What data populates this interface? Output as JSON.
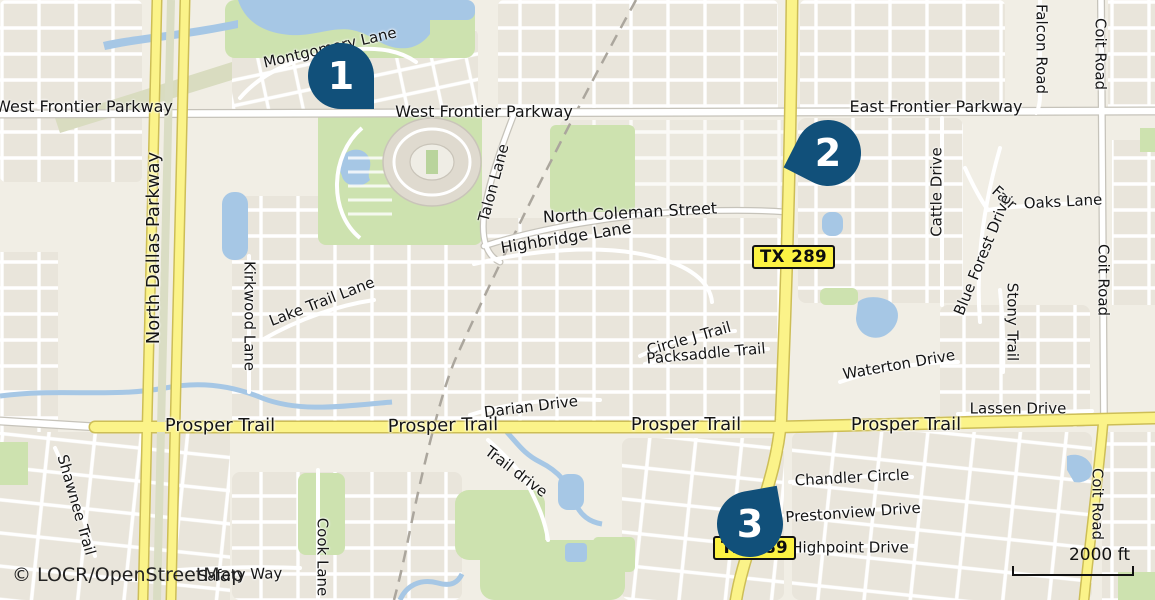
{
  "map": {
    "attribution": "© LOCR/OpenStreetMap",
    "scale_label": "2000 ft",
    "markers": [
      {
        "number": "1"
      },
      {
        "number": "2"
      },
      {
        "number": "3"
      }
    ],
    "shields": [
      {
        "label": "TX 289"
      },
      {
        "label": "TX 289"
      }
    ],
    "street_labels": [
      {
        "text": "West Frontier Parkway"
      },
      {
        "text": "West Frontier Parkway"
      },
      {
        "text": "East Frontier Parkway"
      },
      {
        "text": "Montgomery Lane"
      },
      {
        "text": "North Dallas Parkway"
      },
      {
        "text": "Talon Lane"
      },
      {
        "text": "North Coleman Street"
      },
      {
        "text": "Highbridge Lane"
      },
      {
        "text": "Lake Trail Lane"
      },
      {
        "text": "Kirkwood Lane"
      },
      {
        "text": "Circle J Trail"
      },
      {
        "text": "Packsaddle Trail"
      },
      {
        "text": "Darian Drive"
      },
      {
        "text": "Prosper Trail"
      },
      {
        "text": "Prosper Trail"
      },
      {
        "text": "Prosper Trail"
      },
      {
        "text": "Prosper Trail"
      },
      {
        "text": "Trail drive"
      },
      {
        "text": "Shawnee Trail"
      },
      {
        "text": "Cook Lane"
      },
      {
        "text": "Safety Way"
      },
      {
        "text": "Cattle Drive"
      },
      {
        "text": "Fair"
      },
      {
        "text": "Oaks Lane"
      },
      {
        "text": "Blue Forest Drive"
      },
      {
        "text": "Stony Trail"
      },
      {
        "text": "Waterton Drive"
      },
      {
        "text": "Lassen Drive"
      },
      {
        "text": "Falcon Road"
      },
      {
        "text": "Coit Road"
      },
      {
        "text": "Coit Road"
      },
      {
        "text": "Coit Road"
      },
      {
        "text": "Chandler Circle"
      },
      {
        "text": "Prestonview Drive"
      },
      {
        "text": "Highpoint Drive"
      }
    ],
    "colors": {
      "marker": "#11507A",
      "shield_bg": "#FCF243",
      "road_yellow": "#FBF389",
      "water": "#A6C7E5",
      "green": "#CDE2AF",
      "background": "#F1EEE5"
    }
  }
}
